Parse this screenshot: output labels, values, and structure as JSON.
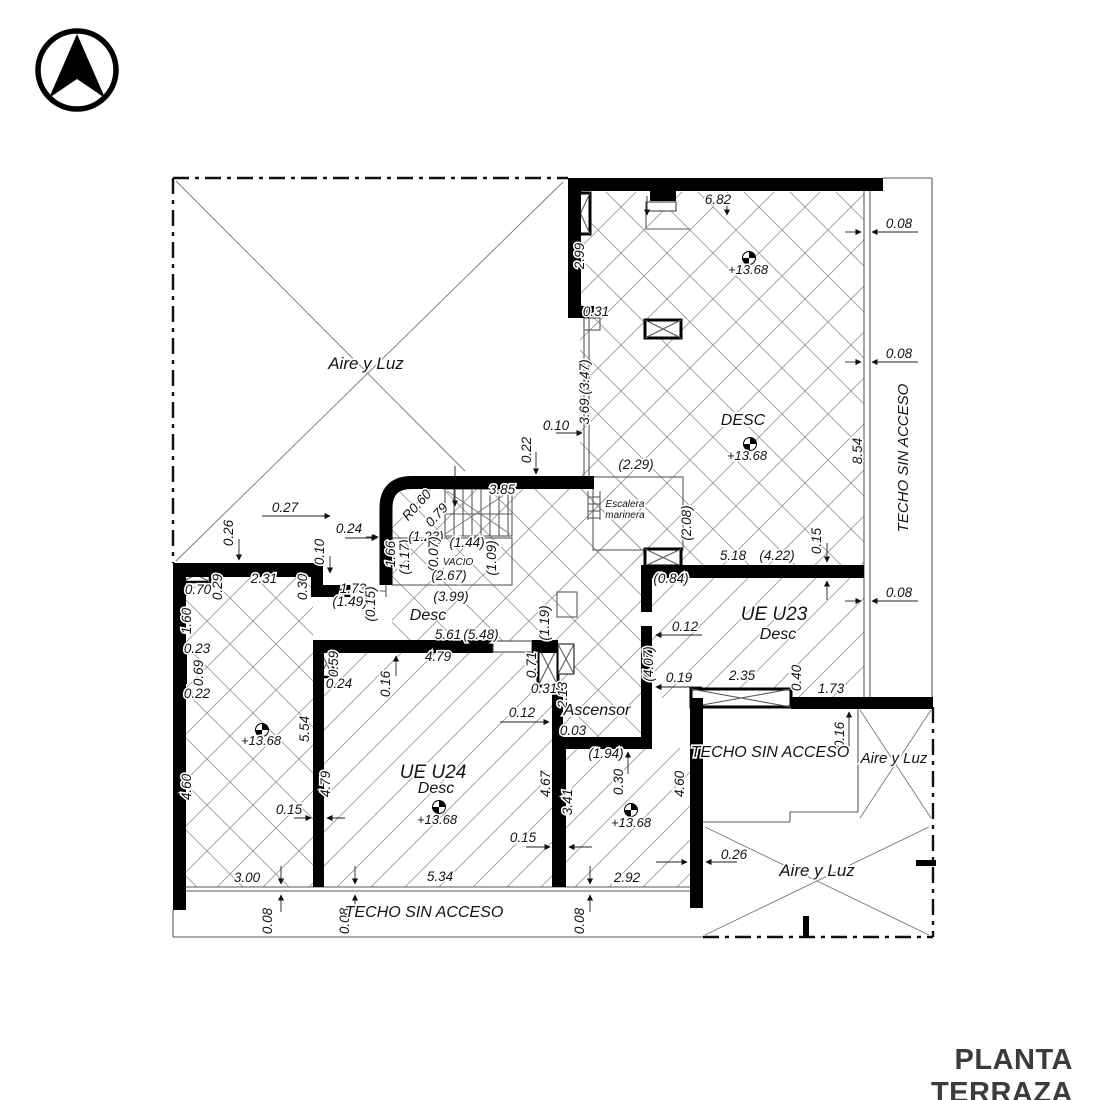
{
  "title": "PLANTA TERRAZA",
  "plan": {
    "level_value": "+13.68",
    "labels": [
      {
        "t": "6.82",
        "x": 718,
        "y": 204
      },
      {
        "t": "0.08",
        "x": 899,
        "y": 228
      },
      {
        "t": "0.08",
        "x": 899,
        "y": 358
      },
      {
        "t": "0.08",
        "x": 899,
        "y": 597
      },
      {
        "t": "2.99",
        "x": 584,
        "y": 256,
        "r": -90
      },
      {
        "t": "0.31",
        "x": 596,
        "y": 316
      },
      {
        "t": "3.69 (3.47)",
        "x": 589,
        "y": 392,
        "r": -90
      },
      {
        "t": "8.54",
        "x": 862,
        "y": 451,
        "r": -90
      },
      {
        "t": "(2.29)",
        "x": 636,
        "y": 469
      },
      {
        "t": "0.10",
        "x": 556,
        "y": 430
      },
      {
        "t": "0.22",
        "x": 531,
        "y": 450,
        "r": -90
      },
      {
        "t": "3.85",
        "x": 502,
        "y": 494
      },
      {
        "t": "R0.60",
        "x": 420,
        "y": 508,
        "r": -48
      },
      {
        "t": "0.79",
        "x": 440,
        "y": 518,
        "r": -48
      },
      {
        "t": "(2.08)",
        "x": 691,
        "y": 523,
        "r": -90
      },
      {
        "t": "5.18",
        "x": 733,
        "y": 560
      },
      {
        "t": "(4.22)",
        "x": 777,
        "y": 560
      },
      {
        "t": "0.15",
        "x": 821,
        "y": 541,
        "r": -90
      },
      {
        "t": "(0.84)",
        "x": 671,
        "y": 583
      },
      {
        "t": "0.12",
        "x": 685,
        "y": 631
      },
      {
        "t": "(4.07)",
        "x": 653,
        "y": 664,
        "r": -90
      },
      {
        "t": "0.19",
        "x": 679,
        "y": 682
      },
      {
        "t": "2.35",
        "x": 742,
        "y": 680
      },
      {
        "t": "0.40",
        "x": 801,
        "y": 678,
        "r": -90
      },
      {
        "t": "1.73",
        "x": 831,
        "y": 693
      },
      {
        "t": "0.16",
        "x": 844,
        "y": 735,
        "r": -90
      },
      {
        "t": "0.12",
        "x": 522,
        "y": 717
      },
      {
        "t": "0.71",
        "x": 536,
        "y": 665,
        "r": -90
      },
      {
        "t": "0.31",
        "x": 544,
        "y": 693
      },
      {
        "t": "2.13",
        "x": 567,
        "y": 695,
        "r": -90
      },
      {
        "t": "0.03",
        "x": 573,
        "y": 735
      },
      {
        "t": "(1.19)",
        "x": 549,
        "y": 623,
        "r": -90
      },
      {
        "t": "(1.94)",
        "x": 606,
        "y": 758
      },
      {
        "t": "0.30",
        "x": 623,
        "y": 782,
        "r": -90
      },
      {
        "t": "4.67",
        "x": 550,
        "y": 784,
        "r": -90
      },
      {
        "t": "3.41",
        "x": 572,
        "y": 802,
        "r": -90
      },
      {
        "t": "4.60",
        "x": 684,
        "y": 784,
        "r": -90
      },
      {
        "t": "0.15",
        "x": 523,
        "y": 842
      },
      {
        "t": "2.92",
        "x": 627,
        "y": 882
      },
      {
        "t": "0.26",
        "x": 734,
        "y": 859
      },
      {
        "t": "3.00",
        "x": 247,
        "y": 882
      },
      {
        "t": "5.34",
        "x": 440,
        "y": 881
      },
      {
        "t": "0.08",
        "x": 272,
        "y": 921,
        "r": -90
      },
      {
        "t": "0.08",
        "x": 349,
        "y": 921,
        "r": -90
      },
      {
        "t": "0.08",
        "x": 584,
        "y": 921,
        "r": -90
      },
      {
        "t": "0.27",
        "x": 285,
        "y": 512
      },
      {
        "t": "0.26",
        "x": 233,
        "y": 533,
        "r": -90
      },
      {
        "t": "0.24",
        "x": 349,
        "y": 533
      },
      {
        "t": "0.10",
        "x": 324,
        "y": 552,
        "r": -90
      },
      {
        "t": "1.66",
        "x": 395,
        "y": 554,
        "r": -90
      },
      {
        "t": "(1.17)",
        "x": 409,
        "y": 557,
        "r": -90
      },
      {
        "t": "(1.23)",
        "x": 426,
        "y": 541
      },
      {
        "t": "(0.07)",
        "x": 438,
        "y": 554,
        "r": -90
      },
      {
        "t": "(1.44)",
        "x": 467,
        "y": 547
      },
      {
        "t": "(1.09)",
        "x": 496,
        "y": 558,
        "r": -90
      },
      {
        "t": "(2.67)",
        "x": 449,
        "y": 580
      },
      {
        "t": "(3.99)",
        "x": 451,
        "y": 601
      },
      {
        "t": "5.61",
        "x": 448,
        "y": 639
      },
      {
        "t": "(5.48)",
        "x": 481,
        "y": 639
      },
      {
        "t": "4.79",
        "x": 438,
        "y": 661
      },
      {
        "t": "1.73",
        "x": 353,
        "y": 593
      },
      {
        "t": "(1.49)",
        "x": 350,
        "y": 606
      },
      {
        "t": "(0.15)",
        "x": 375,
        "y": 604,
        "r": -90
      },
      {
        "t": "2.31",
        "x": 264,
        "y": 583
      },
      {
        "t": "0.29",
        "x": 222,
        "y": 587,
        "r": -90
      },
      {
        "t": "0.30",
        "x": 307,
        "y": 587,
        "r": -90
      },
      {
        "t": "0.70",
        "x": 198,
        "y": 594
      },
      {
        "t": "1.60",
        "x": 191,
        "y": 621,
        "r": -90
      },
      {
        "t": "0.23",
        "x": 197,
        "y": 653
      },
      {
        "t": "0.69",
        "x": 203,
        "y": 673,
        "r": -90
      },
      {
        "t": "0.22",
        "x": 197,
        "y": 698
      },
      {
        "t": "4.60",
        "x": 191,
        "y": 787,
        "r": -90
      },
      {
        "t": "5.54",
        "x": 309,
        "y": 729,
        "r": -90
      },
      {
        "t": "4.79",
        "x": 330,
        "y": 784,
        "r": -90
      },
      {
        "t": "0.15",
        "x": 289,
        "y": 814
      },
      {
        "t": "0.59",
        "x": 338,
        "y": 664,
        "r": -90
      },
      {
        "t": "0.24",
        "x": 339,
        "y": 688
      },
      {
        "t": "0.16",
        "x": 390,
        "y": 684,
        "r": -90
      },
      {
        "t": "+13.68",
        "x": 748,
        "y": 274,
        "s": 13
      },
      {
        "t": "+13.68",
        "x": 747,
        "y": 460,
        "s": 13
      },
      {
        "t": "+13.68",
        "x": 261,
        "y": 745,
        "s": 13
      },
      {
        "t": "+13.68",
        "x": 437,
        "y": 824,
        "s": 13
      },
      {
        "t": "+13.68",
        "x": 631,
        "y": 827,
        "s": 13
      },
      {
        "t": "DESC",
        "x": 743,
        "y": 425,
        "s": 16,
        "cls": "room"
      },
      {
        "t": "UE U23",
        "x": 774,
        "y": 620,
        "s": 19,
        "cls": "room"
      },
      {
        "t": "Desc",
        "x": 778,
        "y": 639,
        "s": 16,
        "cls": "room"
      },
      {
        "t": "UE U24",
        "x": 433,
        "y": 778,
        "s": 19,
        "cls": "room"
      },
      {
        "t": "Desc",
        "x": 436,
        "y": 793,
        "s": 16,
        "cls": "room"
      },
      {
        "t": "Desc",
        "x": 428,
        "y": 620,
        "s": 16,
        "cls": "room"
      },
      {
        "t": "Ascensor",
        "x": 597,
        "y": 715,
        "s": 16,
        "cls": "room"
      },
      {
        "t": "Aire y Luz",
        "x": 366,
        "y": 369,
        "s": 17,
        "cls": "room"
      },
      {
        "t": "Aire y Luz",
        "x": 894,
        "y": 763,
        "s": 15,
        "cls": "room"
      },
      {
        "t": "Aire y Luz",
        "x": 817,
        "y": 876,
        "s": 17,
        "cls": "room"
      },
      {
        "t": "TECHO SIN ACCESO",
        "x": 908,
        "y": 458,
        "r": -90,
        "s": 15,
        "cls": "room"
      },
      {
        "t": "TECHO SIN ACCESO",
        "x": 770,
        "y": 757,
        "s": 16,
        "cls": "room"
      },
      {
        "t": "TECHO SIN ACCESO",
        "x": 424,
        "y": 917,
        "s": 16,
        "cls": "room"
      },
      {
        "t": "Escalera",
        "x": 625,
        "y": 507,
        "s": 10,
        "cls": "room"
      },
      {
        "t": "marinera",
        "x": 625,
        "y": 518,
        "s": 10,
        "cls": "room"
      },
      {
        "t": "VACIO",
        "x": 458,
        "y": 565,
        "s": 10,
        "cls": "room"
      }
    ]
  }
}
